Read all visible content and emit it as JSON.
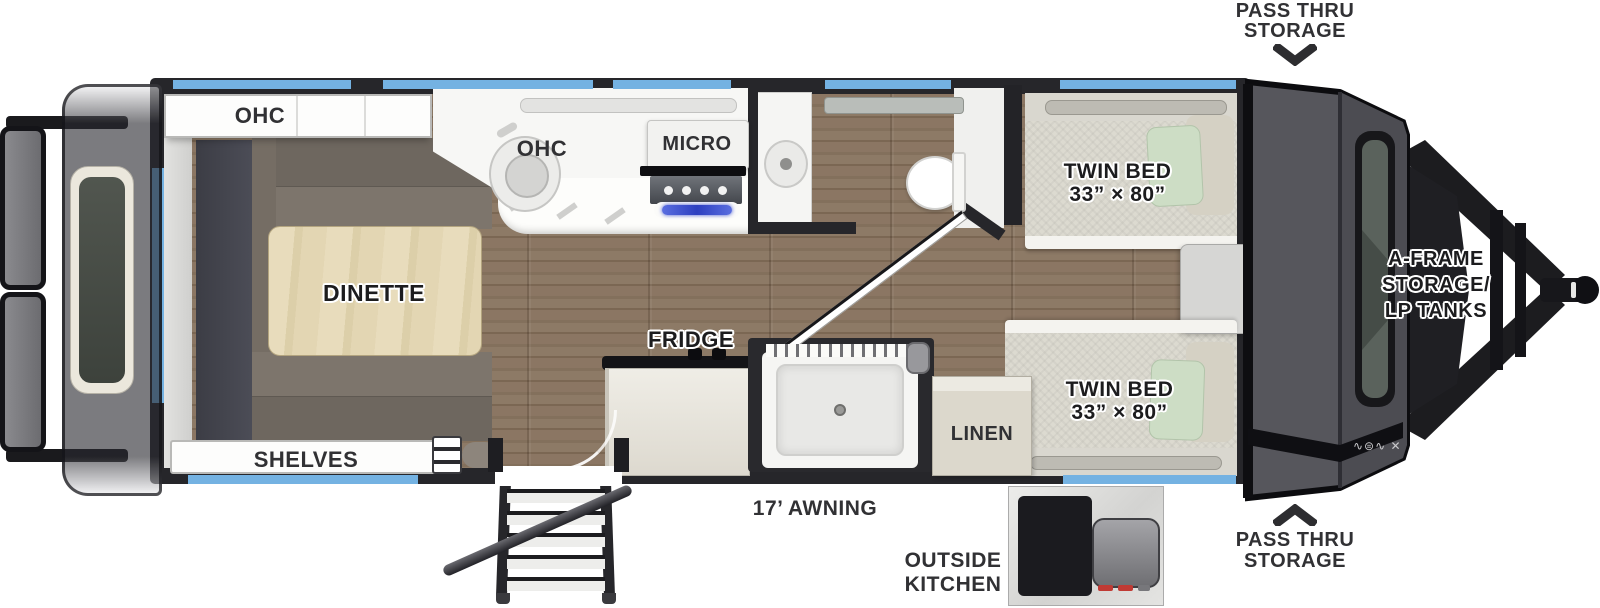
{
  "colors": {
    "accent_window_blue": "#74b2e2",
    "wall_black": "#26262a",
    "floor_wood_brown": "#85715d",
    "front_cap_gray": "#56565c",
    "mattress_beige": "#dcdad0",
    "pillow_green": "#ccdcc5",
    "table_wood_light": "#ddd0ab",
    "bench_taupe": "#7d756c",
    "stove_glow_blue": "#3d50d5"
  },
  "callouts": {
    "pass_thru_top": {
      "line1": "PASS THRU",
      "line2": "STORAGE"
    },
    "pass_thru_bottom": {
      "line1": "PASS THRU",
      "line2": "STORAGE"
    },
    "a_frame": {
      "line1": "A-FRAME",
      "line2": "STORAGE/",
      "line3": "LP TANKS"
    },
    "awning": "17’ AWNING",
    "outside_kitchen": {
      "line1": "OUTSIDE",
      "line2": "KITCHEN"
    }
  },
  "rooms": {
    "ohc_rear": "OHC",
    "ohc_kitchen": "OHC",
    "micro": "MICRO",
    "dinette": "DINETTE",
    "fridge": "FRIDGE",
    "shelves": "SHELVES",
    "linen": "LINEN",
    "twin_bed_top": {
      "line1": "TWIN BED",
      "line2": "33” × 80”"
    },
    "twin_bed_bottom": {
      "line1": "TWIN BED",
      "line2": "33” × 80”"
    }
  },
  "decals": {
    "front_cap_icons": "∿⊜∿ ✕"
  }
}
